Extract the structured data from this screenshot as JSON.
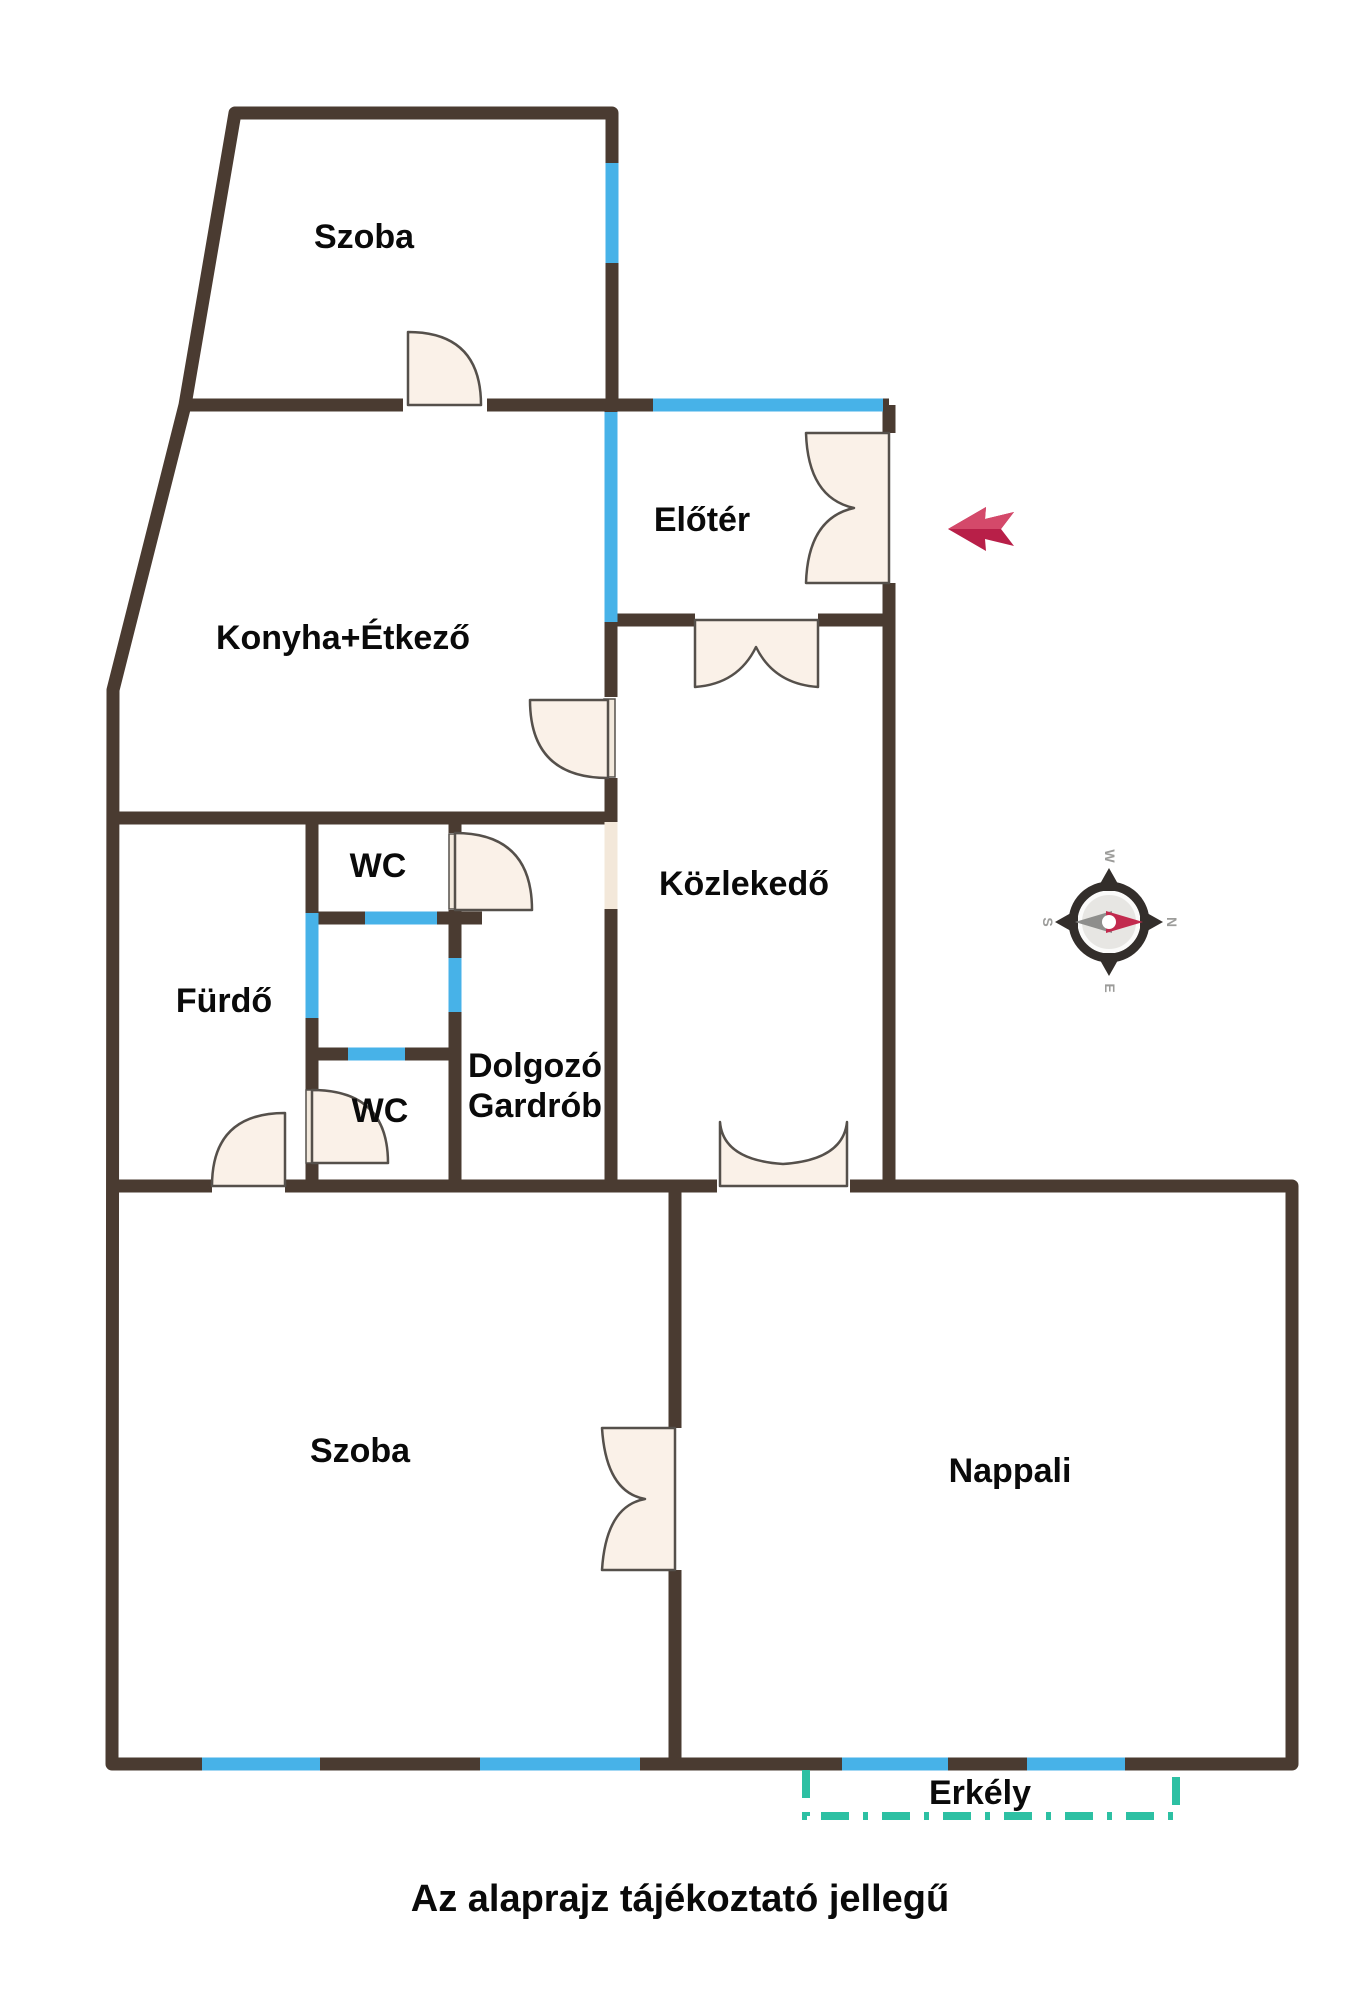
{
  "disclaimer": "Az alaprajz tájékoztató jellegű",
  "rooms": {
    "szoba_top": "Szoba",
    "konyha": "Konyha+Étkező",
    "eloter": "Előtér",
    "kozlekedo": "Közlekedő",
    "wc_upper": "WC",
    "furdo": "Fürdő",
    "wc_lower": "WC",
    "dolgozo_line1": "Dolgozó",
    "dolgozo_line2": "Gardrób",
    "szoba_bottom": "Szoba",
    "nappali": "Nappali",
    "erkely": "Erkély"
  },
  "compass": {
    "north": "N",
    "south": "S",
    "east": "E",
    "west": "W"
  },
  "colors": {
    "wall": "#4a3b31",
    "window": "#47b2e8",
    "door_fill": "#faf1e8",
    "door_outline": "#55504b",
    "balcony_dash": "#2dc0a3",
    "entry_arrow_dark": "#b81f48",
    "entry_arrow_light": "#d4496a",
    "compass_ring": "#332e2b",
    "compass_disc": "#e7e6e3",
    "compass_needle_red": "#c22a4e",
    "compass_needle_gray": "#8e8e8c",
    "label_text": "#0a0a0a"
  }
}
